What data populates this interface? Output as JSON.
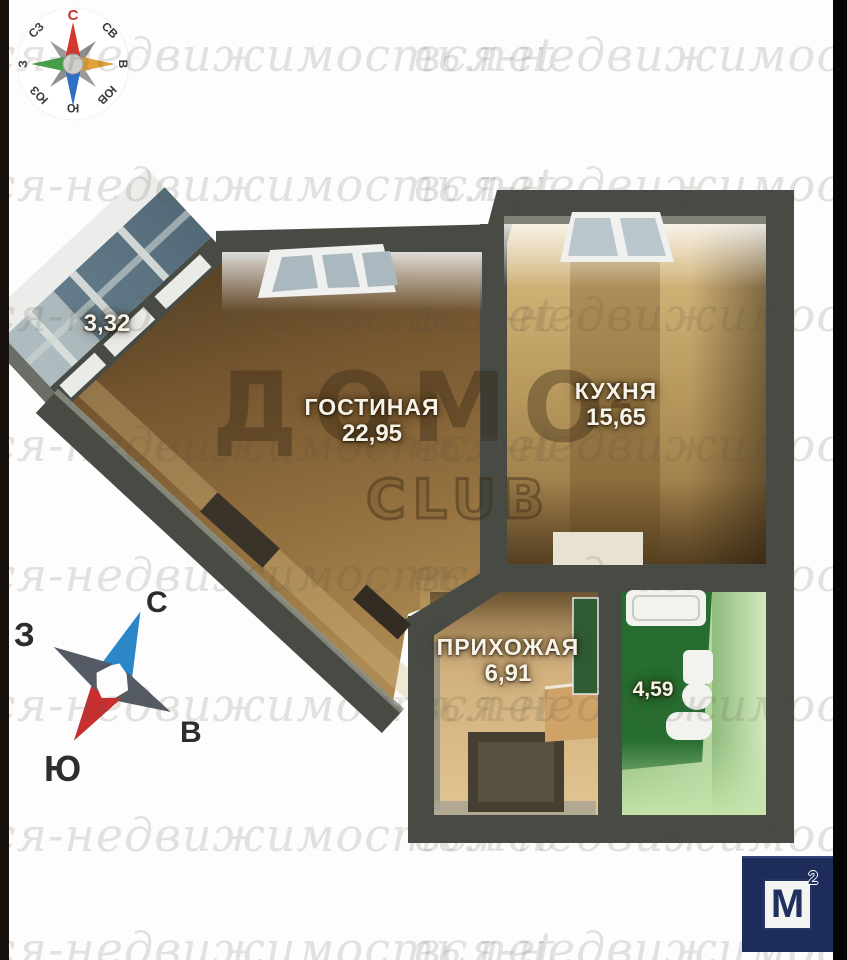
{
  "watermark": {
    "text": "вся-недвижимость.net"
  },
  "brand": {
    "word": "ДОМО",
    "sup": "2",
    "club": "CLUB"
  },
  "compass_rose": {
    "n": "С",
    "ne": "СВ",
    "e": "В",
    "se": "ЮВ",
    "s": "Ю",
    "sw": "ЮЗ",
    "w": "З",
    "nw": "СЗ"
  },
  "compass_star": {
    "n": "С",
    "w": "З",
    "e": "В",
    "s": "Ю"
  },
  "rooms": {
    "living": {
      "name": "ГОСТИНАЯ",
      "area": "22,95"
    },
    "kitchen": {
      "name": "КУХНЯ",
      "area": "15,65"
    },
    "hall": {
      "name": "ПРИХОЖАЯ",
      "area": "6,91"
    },
    "bath": {
      "area": "4,59"
    },
    "balcony": {
      "area": "3,32"
    }
  },
  "logo": {
    "letter": "М",
    "sup": "2"
  },
  "colors": {
    "wall": "#474b44",
    "living_floor": "#7a5a33",
    "kitchen_floor": "#c2a167",
    "hall_floor": "#d8ba88",
    "bath_floor": "#266d2f",
    "bath_wall": "#a9cf92",
    "balcony_glass": "#5c7180",
    "logo_navy": "#1e2c5c",
    "north_red": "#c0392b"
  }
}
